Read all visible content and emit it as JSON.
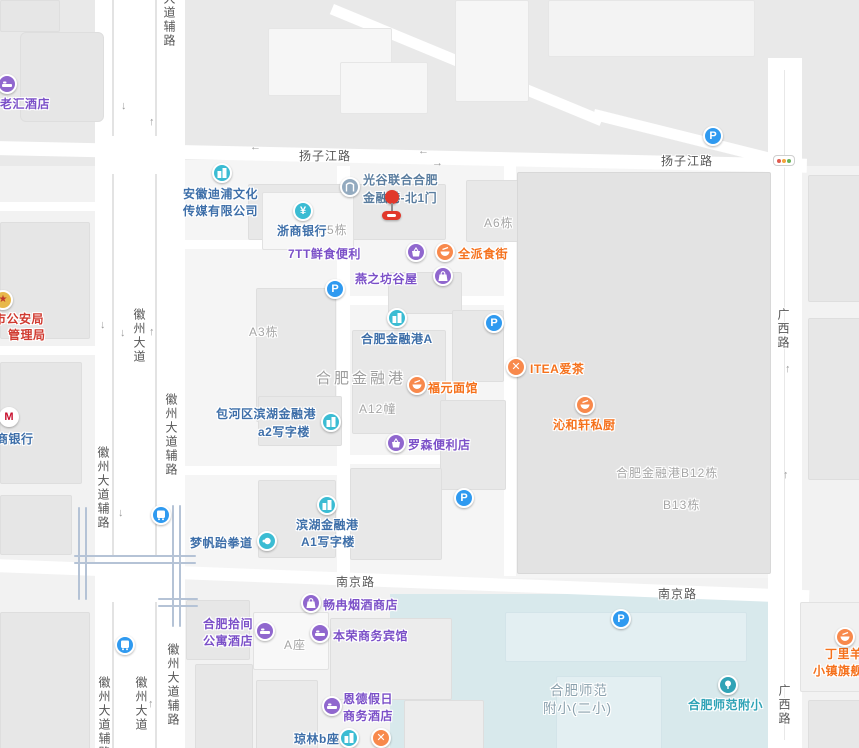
{
  "colors": {
    "map_bg": "#f2f2f2",
    "north_bg": "#e9e9e9",
    "block_bg": "#f5f5f5",
    "building": "#e8e8e8",
    "big_block": "#e3e3e3",
    "school_area": "#d8e9ec",
    "rail_line": "#b5c3d6",
    "road_white": "#ffffff",
    "poi_blue_text": "#3e6fa9",
    "poi_purple_text": "#7b50c8",
    "poi_orange_text": "#f5711c",
    "poi_red_text": "#d03a30",
    "icon_teal": "#3bbcd3",
    "icon_purple": "#9067ce",
    "icon_orange": "#f8894c",
    "icon_blue_parking": "#2f9af0",
    "marker_red": "#e1382b",
    "road_label": "#575757",
    "area_label": "#a5a5a5"
  },
  "icons": {
    "parking": "P",
    "metro_m": "M",
    "yuan": "¥",
    "close": "✕",
    "badge_star": "★",
    "arrow_up": "↑",
    "arrow_down": "↓",
    "arrow_left": "←",
    "arrow_right": "→"
  },
  "roads": {
    "yangzijiang_w": "扬子江路",
    "yangzijiang_e": "扬子江路",
    "nanjing_w": "南京路",
    "nanjing_e": "南京路",
    "guangxi_n": "广西路",
    "guangxi_s": "广西路",
    "huizhou_top_fu": "大道辅路",
    "huizhou_mid": "徽州大道",
    "huizhou_mid_fu_r": "徽州大道辅路",
    "huizhou_mid_fu_l": "徽州大道辅路",
    "huizhou_bot": "徽州大道",
    "huizhou_bot_fu_r": "徽州大道辅路",
    "huizhou_bot_fu_l": "徽州大道辅路"
  },
  "areas": {
    "a5": "A5栋",
    "a6": "A6栋",
    "a3": "A3栋",
    "a12": "A12幢",
    "a_block": "A座",
    "b12": "合肥金融港B12栋",
    "b13": "B13栋",
    "financial_port": "合肥金融港",
    "school_line1": "合肥师范",
    "school_line2": "附小(二小)"
  },
  "pois": {
    "laohui": "老汇酒店",
    "gongan_line1": "市公安局",
    "gongan_line2": "管理局",
    "zhaoshang_bank": "商银行",
    "anhui_line1": "安徽迪浦文化",
    "anhui_line2": "传媒有限公司",
    "zheshang_bank": "浙商银行",
    "gate_line1": "光谷联合合肥",
    "gate_line2": "金融港-北1门",
    "qtt": "7TT鲜食便利",
    "quanpai": "全派食街",
    "yanzhifang": "燕之坊谷屋",
    "jrg_a": "合肥金融港A",
    "fuyuan": "福元面馆",
    "itea": "ITEA爱茶",
    "qinhexuan": "沁和轩私厨",
    "a2_line1": "包河区滨湖金融港",
    "a2_line2": "a2写字楼",
    "lawson": "罗森便利店",
    "binhu_line1": "滨湖金融港",
    "binhu_line2": "A1写字楼",
    "mengfan": "梦帆跆拳道",
    "changran": "畅冉烟酒商店",
    "shijian_line1": "合肥拾间",
    "shijian_line2": "公寓酒店",
    "benrong": "本荣商务宾馆",
    "ende_line1": "恩德假日",
    "ende_line2": "商务酒店",
    "qionglin": "琼林b座",
    "shifan_fuxiao": "合肥师范附小",
    "dingliyang_line1": "丁里羊",
    "dingliyang_line2": "小镇旗舰店"
  }
}
